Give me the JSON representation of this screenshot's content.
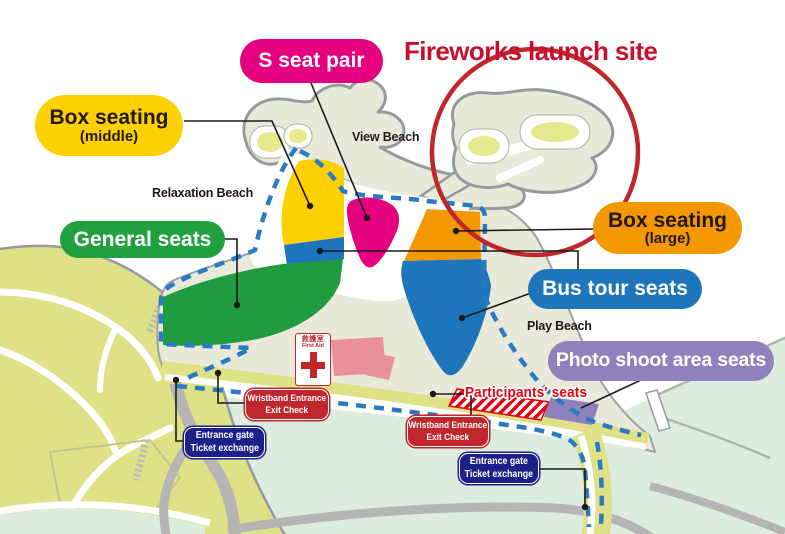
{
  "title": {
    "text": "Fireworks launch site",
    "color": "#c8102e"
  },
  "legend": {
    "s_seat_pair": {
      "label": "S seat pair",
      "bg": "#e4007f",
      "fg": "#ffffff"
    },
    "box_seating_middle": {
      "label": "Box seating",
      "sublabel": "(middle)",
      "bg": "#fdd000",
      "fg": "#231815"
    },
    "general_seats": {
      "label": "General seats",
      "bg": "#21a13d",
      "fg": "#ffffff"
    },
    "box_seating_large": {
      "label": "Box seating",
      "sublabel": "(large)",
      "bg": "#f39800",
      "fg": "#231815"
    },
    "bus_tour_seats": {
      "label": "Bus tour seats",
      "bg": "#1d76bc",
      "fg": "#ffffff"
    },
    "photo_shoot_area_seats": {
      "label": "Photo shoot area seats",
      "bg": "#8f82bc",
      "fg": "#ffffff"
    }
  },
  "beaches": {
    "relaxation": "Relaxation Beach",
    "view": "View Beach",
    "play": "Play Beach"
  },
  "gates": {
    "wristband_check_1": {
      "line1": "Wristband Entrance",
      "line2": "Exit Check",
      "bg": "#c0272d"
    },
    "wristband_check_2": {
      "line1": "Wristband Entrance",
      "line2": "Exit Check",
      "bg": "#c0272d"
    },
    "entrance_gate_1": {
      "line1": "Entrance gate",
      "line2": "Ticket exchange",
      "bg": "#1d2088"
    },
    "entrance_gate_2": {
      "line1": "Entrance gate",
      "line2": "Ticket exchange",
      "bg": "#1d2088"
    }
  },
  "annotations": {
    "participants_seats": {
      "text": "Participants' seats",
      "color": "#e60012"
    },
    "first_aid": {
      "jp": "救護室",
      "en": "First Aid",
      "color": "#c0272d"
    }
  },
  "map_colors": {
    "land": "#dee185",
    "beach_sand": "#e9e9da",
    "lawn_water": "#dcecdf",
    "coast_stroke": "#939b9e",
    "route_dashed": "#2b7bc4",
    "road_gray": "#b5b5b5",
    "launch_circle": "#c0272d",
    "participants_hatch": "#e60012"
  }
}
